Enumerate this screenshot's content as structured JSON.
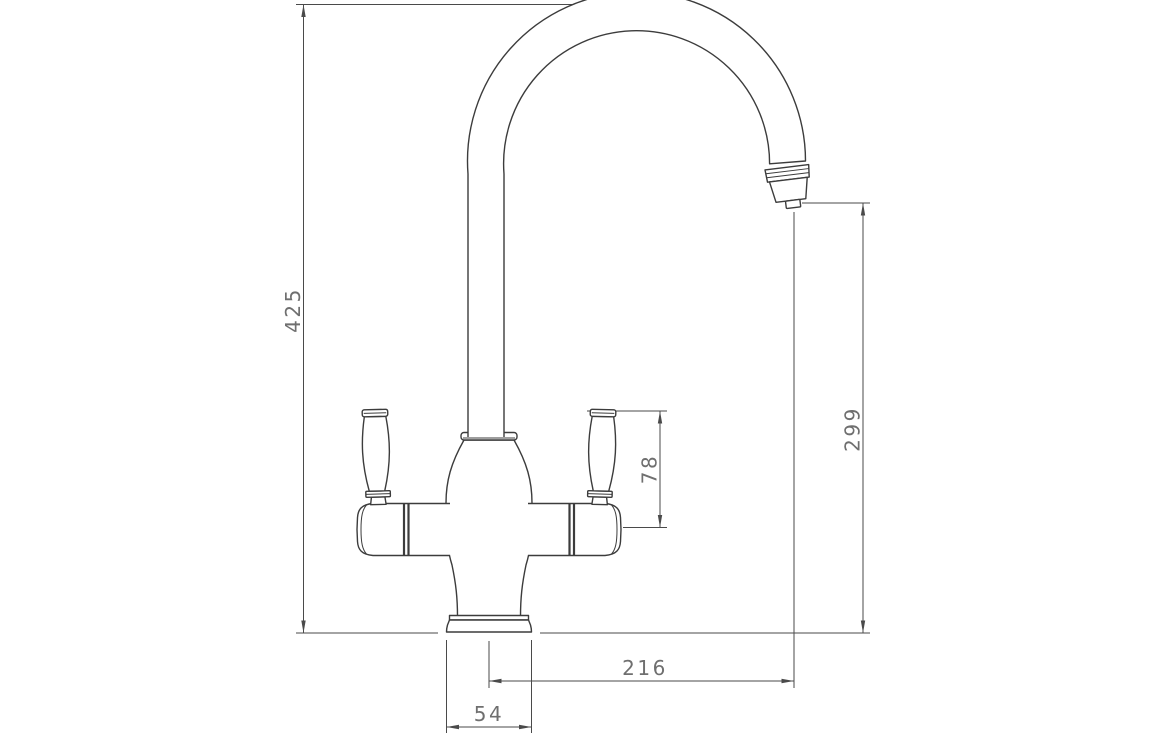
{
  "drawing": {
    "kind": "technical dimension drawing",
    "subject": "two-handle gooseneck mixer tap, side elevation"
  },
  "dimensions": {
    "overall_height": {
      "label": "425",
      "orientation": "vertical"
    },
    "spout_outlet_height": {
      "label": "299",
      "orientation": "vertical"
    },
    "handle_height": {
      "label": "78",
      "orientation": "vertical"
    },
    "spout_reach": {
      "label": "216",
      "orientation": "horizontal"
    },
    "base_width": {
      "label": "54",
      "orientation": "horizontal"
    }
  },
  "colors": {
    "line": "#3c3c3c",
    "dim_line": "#4a4a4a",
    "text": "#6f6f6f",
    "background": "#ffffff"
  }
}
